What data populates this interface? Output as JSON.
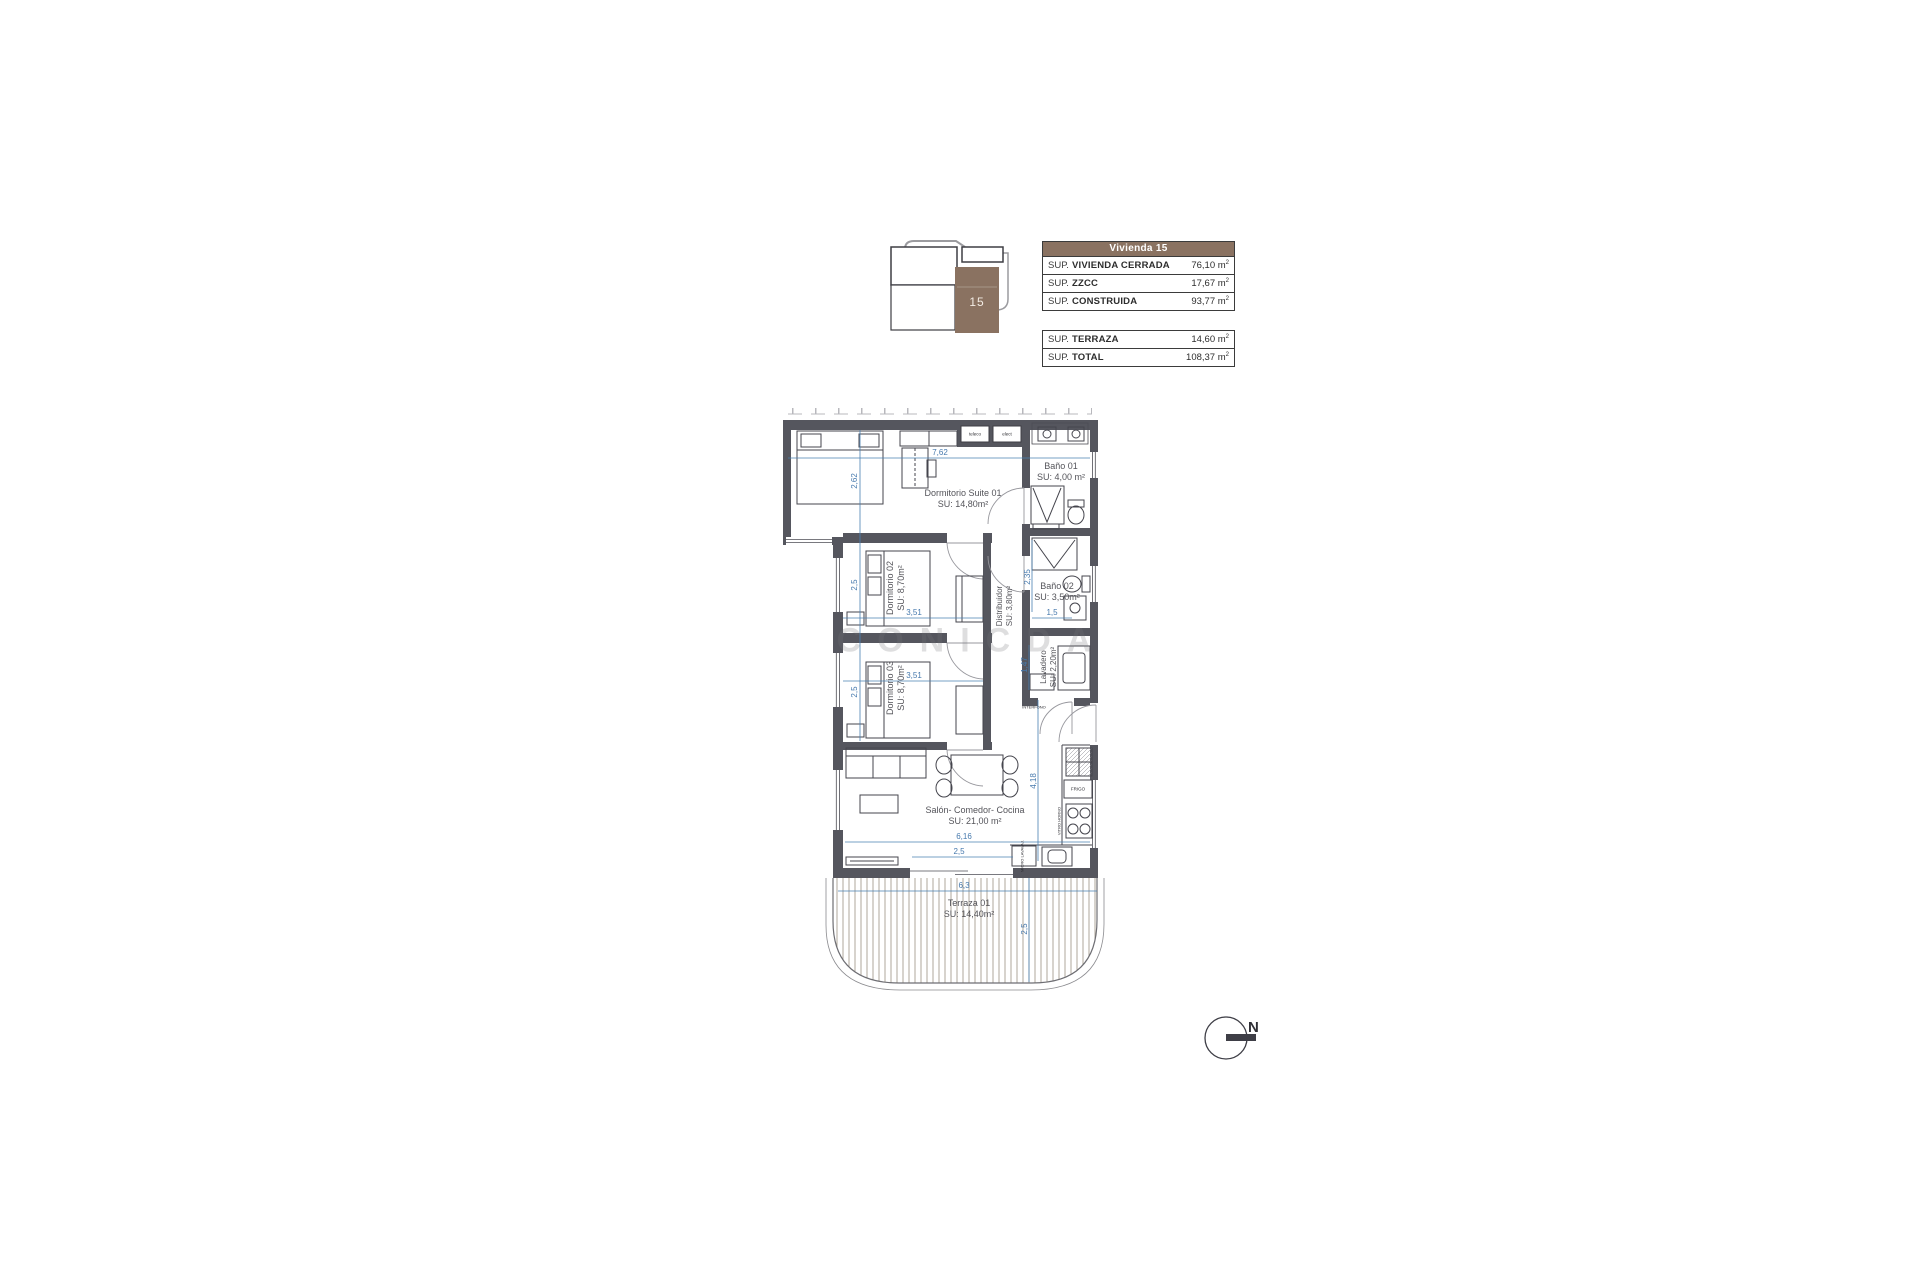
{
  "key_plan": {
    "unit_label": "15",
    "accent_brown": "#8a7261"
  },
  "summary": {
    "header": "Vivienda 15",
    "table1": [
      {
        "prefix": "SUP.",
        "name": "VIVIENDA CERRADA",
        "value": "76,10 m",
        "sup": "2"
      },
      {
        "prefix": "SUP.",
        "name": "ZZCC",
        "value": "17,67 m",
        "sup": "2"
      },
      {
        "prefix": "SUP.",
        "name": "CONSTRUIDA",
        "value": "93,77 m",
        "sup": "2"
      }
    ],
    "table2": [
      {
        "prefix": "SUP.",
        "name": "TERRAZA",
        "value": "14,60 m",
        "sup": "2"
      },
      {
        "prefix": "SUP.",
        "name": "TOTAL",
        "value": "108,37 m",
        "sup": "2"
      }
    ]
  },
  "rooms": [
    {
      "name": "Dormitorio Suite 01",
      "area": "SU: 14,80m²"
    },
    {
      "name": "Baño 01",
      "area": "SU: 4,00 m²"
    },
    {
      "name": "Dormitorio 02",
      "area": "SU: 8,70m²"
    },
    {
      "name": "Baño 02",
      "area": "SU: 3,50m²"
    },
    {
      "name": "Distribuidor",
      "area": "SU: 3,80m²"
    },
    {
      "name": "Lavadero",
      "area": "SU: 2,20m²"
    },
    {
      "name": "Dormitorio 03",
      "area": "SU: 8,70m²"
    },
    {
      "name": "Salón- Comedor- Cocina",
      "area": "SU: 21,00 m²"
    },
    {
      "name": "Terraza 01",
      "area": "SU: 14,40m²"
    }
  ],
  "dimensions": {
    "d1": "7,62",
    "d2": "2,62",
    "d3": "2,5",
    "d4": "3,51",
    "d5": "2,35",
    "d6": "1,5",
    "d7": "1,47",
    "d8": "3,51",
    "d9": "2,5",
    "d10": "4,18",
    "d11": "6,16",
    "d12": "2,5",
    "d13": "6,3",
    "d14": "2,5"
  },
  "small_labels": {
    "teleco": "teleco",
    "elect": "elect",
    "interfono": "INTERFONO",
    "frigo": "FRIGO",
    "vitro_horno": "VITRO HORNO",
    "micro_lavavajillas": "MICRO LAVAVAJ.",
    "watermark": "CONICDA"
  },
  "compass": {
    "north": "N"
  }
}
